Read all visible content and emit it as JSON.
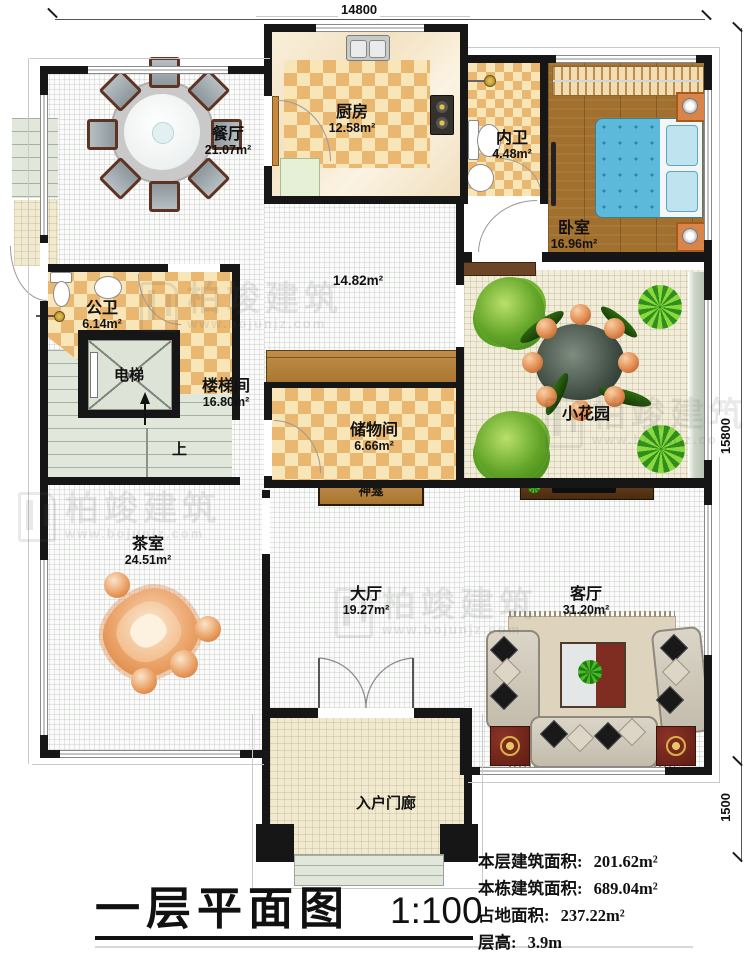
{
  "plan": {
    "dims": {
      "top": "14800",
      "right": "15800",
      "bottom_right": "1500"
    },
    "rooms": {
      "dining": {
        "name": "餐厅",
        "area": "21.07m²"
      },
      "kitchen": {
        "name": "厨房",
        "area": "12.58m²"
      },
      "inner_bath": {
        "name": "内卫",
        "area": "4.48m²"
      },
      "bedroom": {
        "name": "卧室",
        "area": "16.96m²"
      },
      "corridor": {
        "area": "14.82m²"
      },
      "public_bath": {
        "name": "公卫",
        "area": "6.14m²"
      },
      "elevator": {
        "name": "电梯"
      },
      "stairwell": {
        "name": "楼梯间",
        "area": "16.80m²"
      },
      "storage": {
        "name": "储物间",
        "area": "6.66m²"
      },
      "garden": {
        "name": "小花园"
      },
      "tea_room": {
        "name": "茶室",
        "area": "24.51m²"
      },
      "great_hall": {
        "name": "大厅",
        "area": "19.27m²"
      },
      "living_room": {
        "name": "客厅",
        "area": "31.20m²"
      },
      "porch": {
        "name": "入户门廊"
      }
    },
    "annotations": {
      "stairs_up": "上",
      "shrine": "神龛"
    }
  },
  "title_block": {
    "title": "一层平面图",
    "scale": "1:100",
    "stats": [
      {
        "label": "本层建筑面积:",
        "value": "201.62m²"
      },
      {
        "label": "本栋建筑面积:",
        "value": "689.04m²"
      },
      {
        "label": "占地面积:",
        "value": "237.22m²"
      },
      {
        "label": "层高:",
        "value": "3.9m"
      }
    ]
  },
  "watermark": {
    "name": "柏竣建筑",
    "url": "www.bojunjz.com"
  }
}
